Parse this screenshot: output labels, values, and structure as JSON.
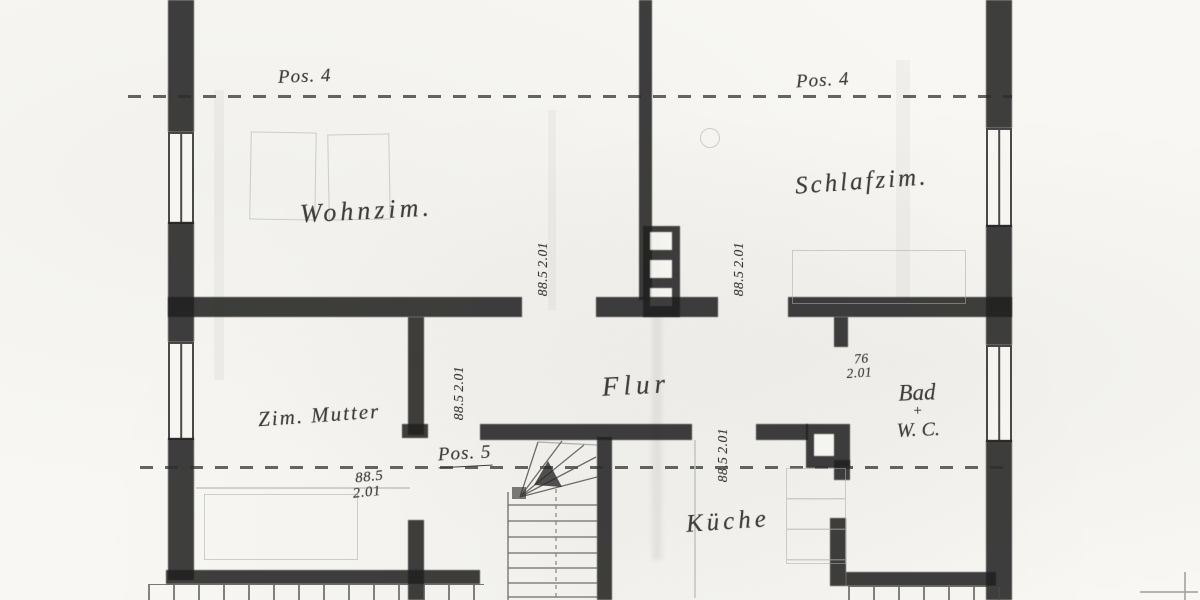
{
  "scan": {
    "paper_color": "#f8f7f3",
    "ink_color": "#202020",
    "pencil_color": "#3c3c3c"
  },
  "position_labels": {
    "pos4_left": "Pos. 4",
    "pos4_right": "Pos. 4",
    "pos5": "Pos. 5"
  },
  "rooms": {
    "living": "Wohnzim.",
    "bedroom": "Schlafzim.",
    "mother": "Zim. Mutter",
    "hall": "Flur",
    "bath_line1": "Bad",
    "bath_line2": "+",
    "bath_line3": "W. C.",
    "kitchen": "Küche"
  },
  "door_dimensions": {
    "living_door": {
      "w": "88.5",
      "h": "2.01"
    },
    "bedroom_door": {
      "w": "88.5",
      "h": "2.01"
    },
    "mother_door": {
      "w": "88.5",
      "h": "2.01"
    },
    "pos5_door": {
      "w": "88.5",
      "h": "2.01"
    },
    "bath_door": {
      "w": "76",
      "h": "2.01"
    },
    "kitchen_door": {
      "w": "88.5",
      "h": "2.01"
    }
  }
}
